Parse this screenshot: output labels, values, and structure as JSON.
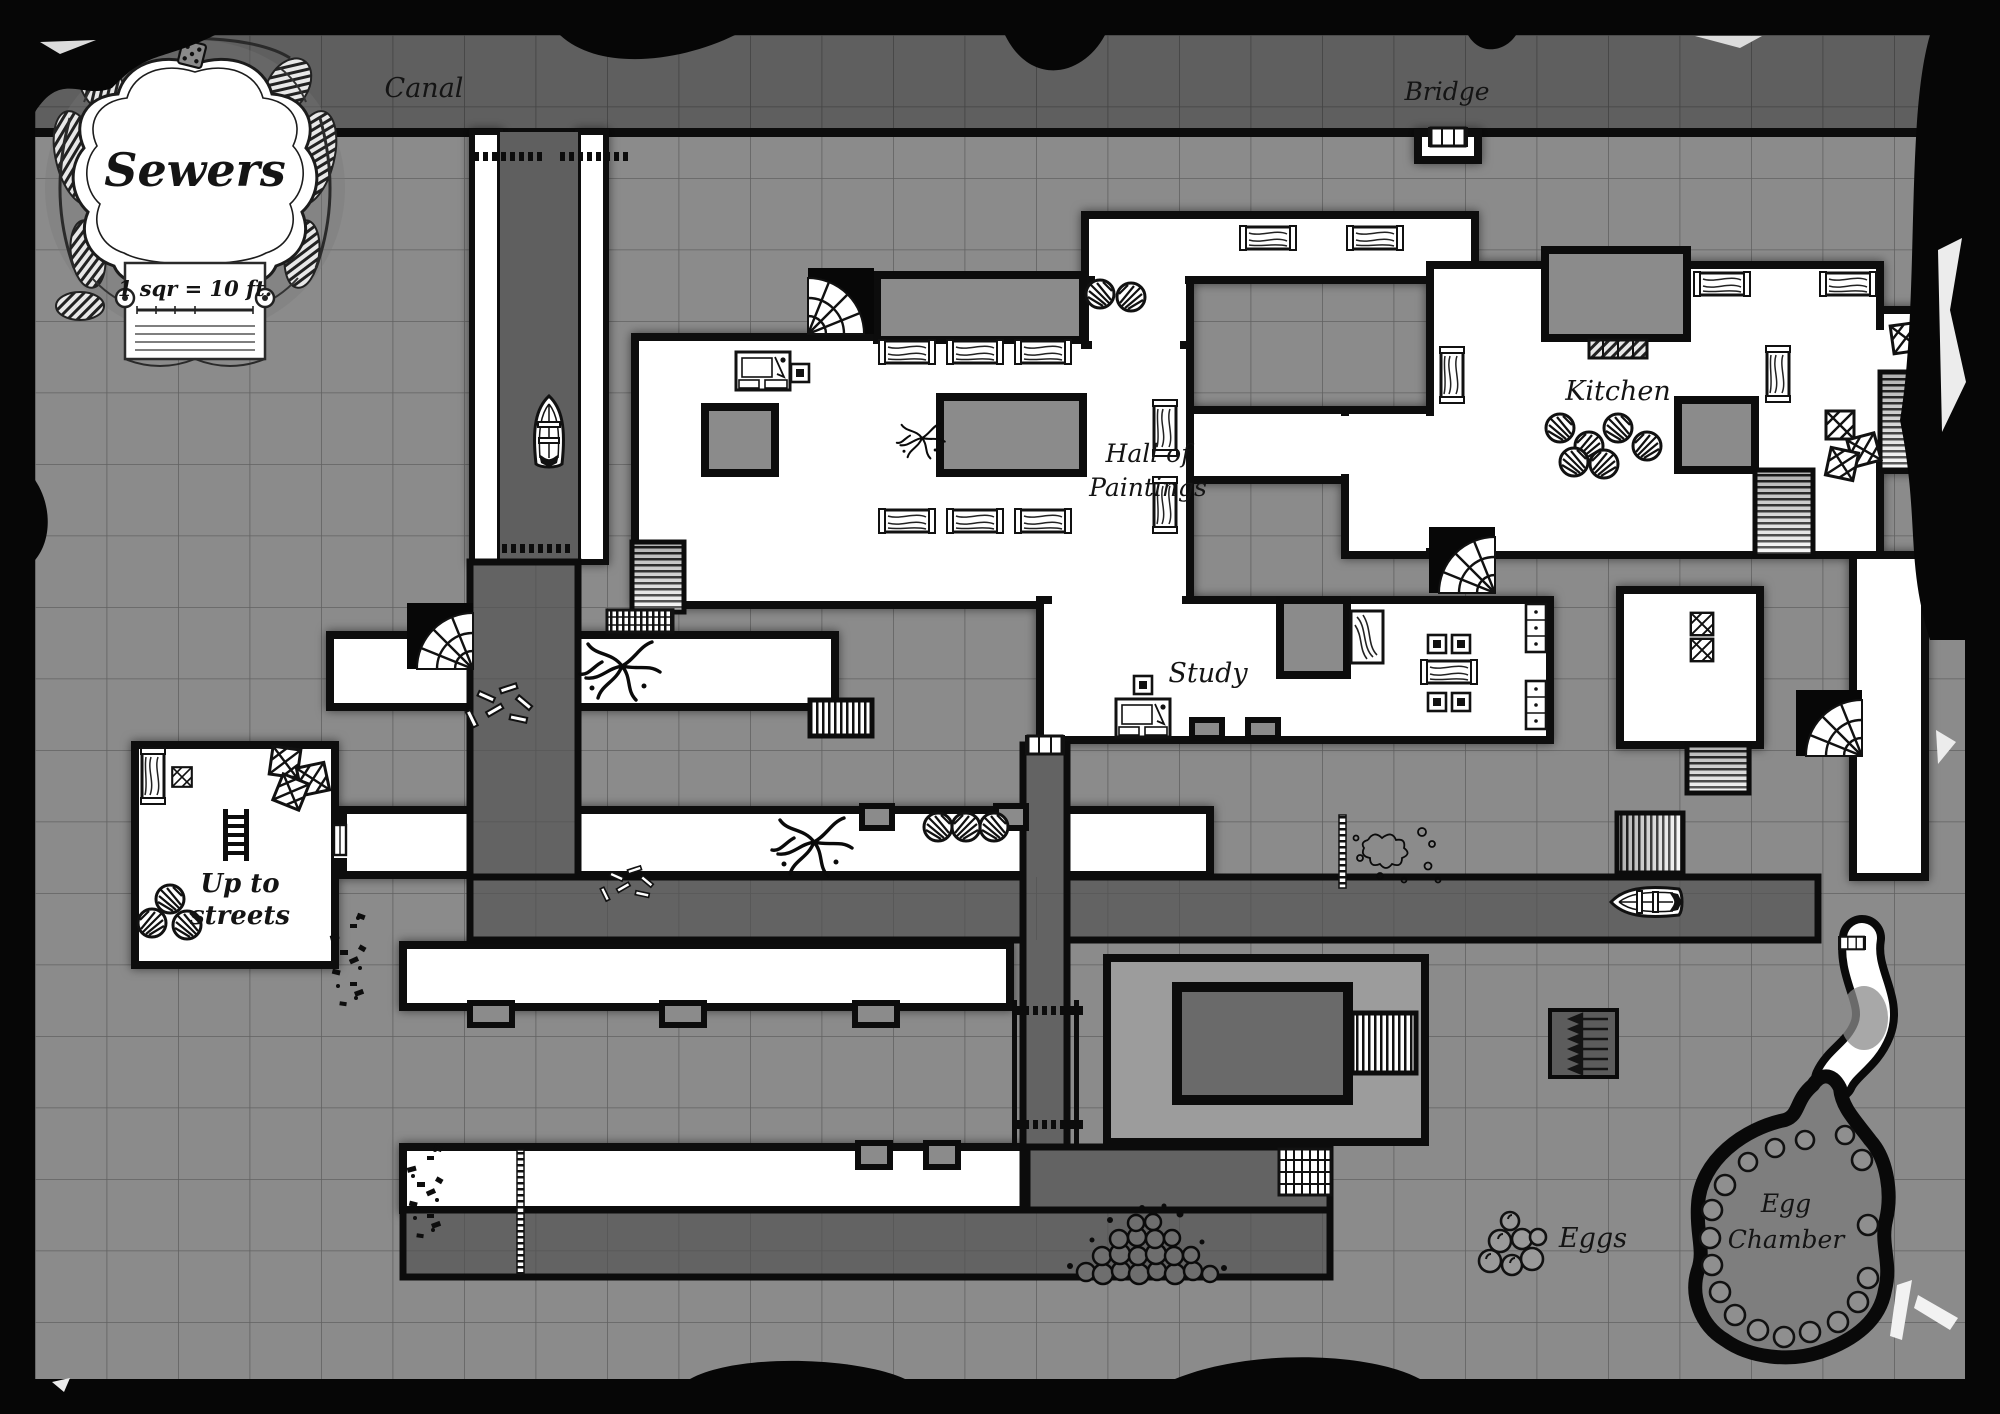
{
  "map": {
    "title": "Sewers",
    "scale_note": "1 sqr = 10 ft.",
    "grid_square_px": 71.5,
    "labels": [
      {
        "id": "canal",
        "text": "Canal"
      },
      {
        "id": "bridge",
        "text": "Bridge"
      },
      {
        "id": "kitchen",
        "text": "Kitchen"
      },
      {
        "id": "hall-of-paintings-line1",
        "text": "Hall of"
      },
      {
        "id": "hall-of-paintings-line2",
        "text": "Paintings"
      },
      {
        "id": "study",
        "text": "Study"
      },
      {
        "id": "up-to-streets-line1",
        "text": "Up to"
      },
      {
        "id": "up-to-streets-line2",
        "text": "streets"
      },
      {
        "id": "eggs",
        "text": "Eggs"
      },
      {
        "id": "egg-chamber-line1",
        "text": "Egg"
      },
      {
        "id": "egg-chamber-line2",
        "text": "Chamber"
      }
    ],
    "colors": {
      "border_black": "#060606",
      "stone_gray": "#8b8b8b",
      "water_gray": "#5f5f5f",
      "room_white": "#ffffff",
      "wall_black": "#0c0c0c",
      "label_ink": "#141414"
    },
    "icons": [
      "boat-icon",
      "bridge-icon",
      "barrel-icon",
      "crate-icon",
      "table-icon",
      "chair-icon",
      "desk-icon",
      "bed-icon",
      "cabinet-icon",
      "stove-icon",
      "ladder-icon",
      "stairs-icon",
      "fan-stairs-icon",
      "grate-icon",
      "portcullis-icon",
      "roots-icon",
      "moss-icon",
      "debris-icon",
      "rubble-icon",
      "egg-pile-icon",
      "egg-chamber-icon",
      "weir-arrows-icon",
      "door-icon",
      "dice-icon"
    ]
  }
}
